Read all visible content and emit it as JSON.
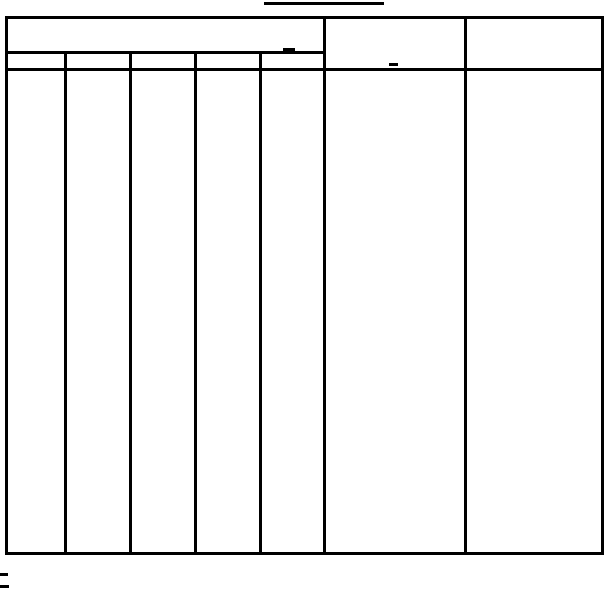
{
  "colors": {
    "ink": "#000000",
    "paper": "#ffffff"
  },
  "title": {
    "text": ""
  },
  "table": {
    "top_header": {
      "left_span_label": "",
      "middle_label": "",
      "right_label": ""
    },
    "sub_headers": [
      {
        "label": ""
      },
      {
        "label": ""
      },
      {
        "label": ""
      },
      {
        "label": ""
      },
      {
        "label": ""
      }
    ],
    "body_cells": [
      {
        "value": ""
      },
      {
        "value": ""
      },
      {
        "value": ""
      },
      {
        "value": ""
      },
      {
        "value": ""
      },
      {
        "value": ""
      },
      {
        "value": ""
      }
    ]
  },
  "marks": {
    "title_underline": "blank-title-underline",
    "header_cell_dash": "small-stray-dash",
    "middle_cell_dash": "small-stray-dash",
    "footnote_rule_1": "short-footnote-dash",
    "footnote_rule_2": "short-footnote-dash"
  },
  "footnotes": [
    {
      "text": ""
    },
    {
      "text": ""
    }
  ]
}
